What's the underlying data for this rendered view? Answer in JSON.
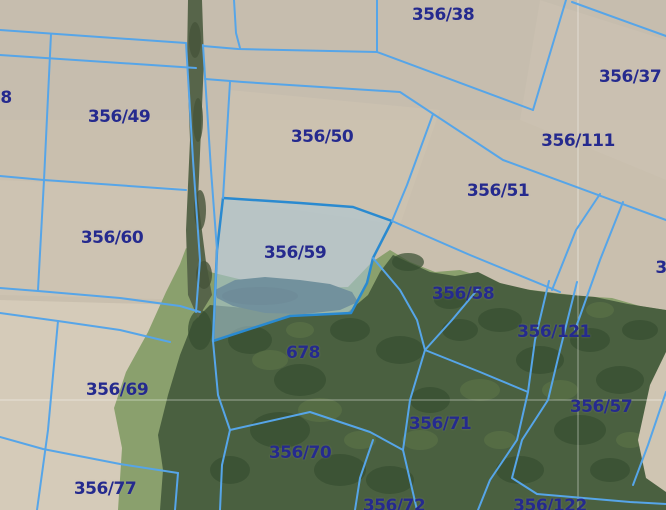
{
  "map": {
    "type": "cadastral-parcel-map-over-aerial-photo",
    "selected_parcel": {
      "id": "356/59",
      "label": "356/59",
      "fill": "#a9c8d8",
      "stroke": "#2a8ad0"
    },
    "colors": {
      "parcel_line": "#56a5e8",
      "label_text": "#252a8e",
      "field_tan": "#c9bfae",
      "field_light": "#d8cfbc",
      "grass": "#8aa06d",
      "forest": "#4a6040",
      "forest_dark": "#374e31",
      "pond": "#2f4e55",
      "hedge": "#57654a",
      "grid_line": "#ffffff"
    },
    "grid": {
      "vertical_x": 578,
      "horizontal_y": 400
    },
    "labels": [
      {
        "id": "356-38",
        "text": "356/38",
        "x": 443,
        "y": 15,
        "partial": false
      },
      {
        "id": "356-37",
        "text": "356/37",
        "x": 630,
        "y": 77,
        "partial": false
      },
      {
        "id": "8-partial",
        "text": "8",
        "x": 6,
        "y": 98,
        "partial": true
      },
      {
        "id": "356-49",
        "text": "356/49",
        "x": 119,
        "y": 117,
        "partial": false
      },
      {
        "id": "356-50",
        "text": "356/50",
        "x": 322,
        "y": 137,
        "partial": false
      },
      {
        "id": "356-111",
        "text": "356/111",
        "x": 578,
        "y": 141,
        "partial": false
      },
      {
        "id": "356-51",
        "text": "356/51",
        "x": 498,
        "y": 191,
        "partial": false
      },
      {
        "id": "356-60",
        "text": "356/60",
        "x": 112,
        "y": 238,
        "partial": false
      },
      {
        "id": "356-59",
        "text": "356/59",
        "x": 295,
        "y": 253,
        "partial": false
      },
      {
        "id": "3-partial",
        "text": "3",
        "x": 661,
        "y": 268,
        "partial": true
      },
      {
        "id": "356-58",
        "text": "356/58",
        "x": 463,
        "y": 294,
        "partial": false
      },
      {
        "id": "356-121",
        "text": "356/121",
        "x": 554,
        "y": 332,
        "partial": false
      },
      {
        "id": "678",
        "text": "678",
        "x": 303,
        "y": 353,
        "partial": false
      },
      {
        "id": "356-69",
        "text": "356/69",
        "x": 117,
        "y": 390,
        "partial": false
      },
      {
        "id": "356-57",
        "text": "356/57",
        "x": 601,
        "y": 407,
        "partial": false
      },
      {
        "id": "356-71",
        "text": "356/71",
        "x": 440,
        "y": 424,
        "partial": false
      },
      {
        "id": "356-70",
        "text": "356/70",
        "x": 300,
        "y": 453,
        "partial": false
      },
      {
        "id": "356-77",
        "text": "356/77",
        "x": 105,
        "y": 489,
        "partial": false
      },
      {
        "id": "356-72",
        "text": "356/72",
        "x": 394,
        "y": 506,
        "partial": true
      },
      {
        "id": "356-122",
        "text": "356/122",
        "x": 550,
        "y": 506,
        "partial": true
      }
    ]
  }
}
